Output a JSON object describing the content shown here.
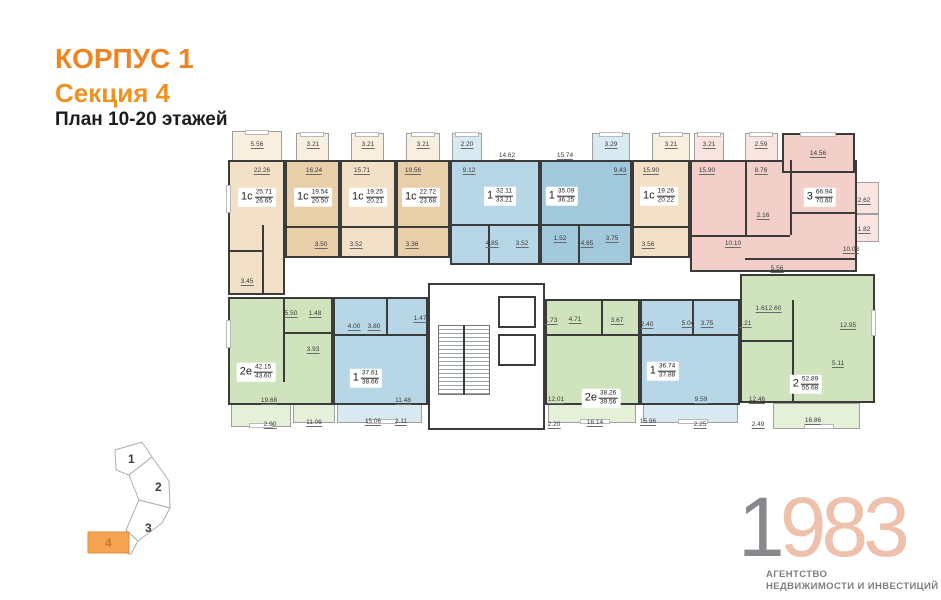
{
  "header": {
    "building": "КОРПУС 1",
    "section": "Секция 4",
    "plan_floors": "План 10-20 этажей"
  },
  "colors": {
    "accent_orange": "#ee8522",
    "title_black": "#1c1c1c",
    "wall": "#3b3b3b",
    "beige": "#f2e1c7",
    "beige_dark": "#e9cfa9",
    "beige_t": "#f8efdf",
    "blue": "#b7d7e6",
    "blue_dark": "#a2c8dc",
    "blue_t": "#d8e9f1",
    "pink": "#f3cfc9",
    "pink_t": "#f9e4df",
    "green": "#cfe4bd",
    "green_t": "#e5f0d9",
    "minimap_active": "#f4a351",
    "logo_gray": "#87898c",
    "logo_salmon": "#edc1ac"
  },
  "apartments": [
    {
      "type": "1с",
      "area_living": "25.71",
      "area_total": "26.65",
      "dims": [
        "5.56",
        "22.26",
        "3.45"
      ]
    },
    {
      "type": "1с",
      "area_living": "19.54",
      "area_total": "20.50",
      "dims": [
        "3.21",
        "16.24",
        "3.50"
      ]
    },
    {
      "type": "1с",
      "area_living": "19.25",
      "area_total": "20.21",
      "dims": [
        "3.21",
        "15.71",
        "3.52"
      ]
    },
    {
      "type": "1с",
      "area_living": "22.72",
      "area_total": "23.68",
      "dims": [
        "3.21",
        "19.56",
        "3.36"
      ]
    },
    {
      "type": "1",
      "area_living": "32.11",
      "area_total": "33.21",
      "dims": [
        "2.20",
        "14.62",
        "9.12",
        "4.85",
        "3.52"
      ]
    },
    {
      "type": "1",
      "area_living": "35.09",
      "area_total": "36.25",
      "dims": [
        "3.29",
        "15.74",
        "9.43",
        "1.52",
        "4.65",
        "3.75"
      ]
    },
    {
      "type": "1с",
      "area_living": "19.26",
      "area_total": "20.22",
      "dims": [
        "3.21",
        "15.90",
        "3.56"
      ]
    },
    {
      "type": "3",
      "area_living": "66.94",
      "area_total": "70.60",
      "dims": [
        "3.21",
        "2.59",
        "14.56",
        "15.90",
        "8.76",
        "2.16",
        "10.10",
        "5.56",
        "10.03",
        "2.62",
        "1.82"
      ]
    },
    {
      "type": "2е",
      "area_living": "42.15",
      "area_total": "43.60",
      "dims": [
        "5.50",
        "1.48",
        "3.93",
        "19.68",
        "2.90",
        "11.06"
      ]
    },
    {
      "type": "1",
      "area_living": "37.61",
      "area_total": "38.66",
      "dims": [
        "4.00",
        "3.80",
        "1.47",
        "11.48",
        "15.06",
        "2.11"
      ]
    },
    {
      "type": "2е",
      "area_living": "38.26",
      "area_total": "39.56",
      "dims": [
        "1.73",
        "4.71",
        "3.67",
        "12.01",
        "2.20",
        "16.14"
      ]
    },
    {
      "type": "1",
      "area_living": "36.74",
      "area_total": "37.88",
      "dims": [
        "2.40",
        "5.04",
        "3.75",
        "9.59",
        "15.96",
        "2.25"
      ]
    },
    {
      "type": "2",
      "area_living": "52.89",
      "area_total": "55.68",
      "dims": [
        "1.61",
        "2.60",
        "6.21",
        "12.95",
        "5.11",
        "12.46",
        "2.49",
        "16.86"
      ]
    }
  ],
  "minimap": {
    "labels": [
      "1",
      "2",
      "3",
      "4"
    ],
    "active": "4"
  },
  "logo": {
    "digit_gray": "1",
    "digits_accent": "983",
    "caption_line1": "АГЕНТСТВО",
    "caption_line2": "НЕДВИЖИМОСТИ И ИНВЕСТИЦИЙ"
  }
}
